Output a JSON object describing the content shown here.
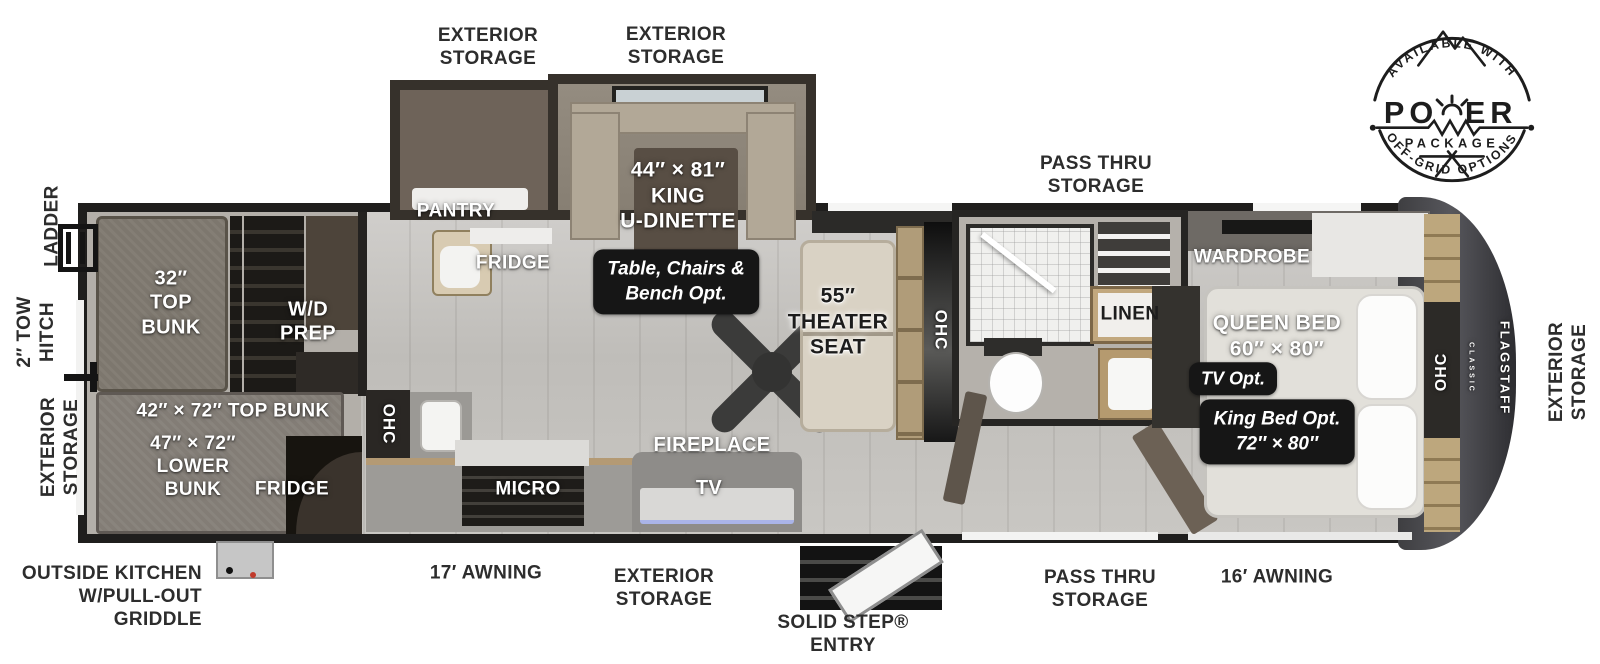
{
  "plan": {
    "exterior": {
      "ext_storage_top_left": "EXTERIOR\nSTORAGE",
      "ext_storage_top_right": "EXTERIOR\nSTORAGE",
      "pass_thru_top": "PASS THRU\nSTORAGE",
      "ladder": "LADDER",
      "tow_hitch": "2″ TOW\nHITCH",
      "ext_storage_rear": "EXTERIOR\nSTORAGE",
      "ext_storage_front": "EXTERIOR\nSTORAGE",
      "outside_kitchen": "OUTSIDE KITCHEN\nW/PULL-OUT\nGRIDDLE",
      "awning_17": "17′ AWNING",
      "ext_storage_bottom": "EXTERIOR\nSTORAGE",
      "solid_step": "SOLID STEP®\nENTRY",
      "pass_thru_bottom": "PASS THRU\nSTORAGE",
      "awning_16": "16′ AWNING"
    },
    "interior": {
      "pantry": "PANTRY",
      "fridge": "FRIDGE",
      "dinette": "44″ × 81″\nKING\nU-DINETTE",
      "dinette_option": "Table, Chairs &\nBench Opt.",
      "theater_seat": "55″\nTHEATER\nSEAT",
      "ohc_theater": "OHC",
      "ohc_kitchen": "OHC",
      "micro": "MICRO",
      "fireplace": "FIREPLACE",
      "tv": "TV",
      "bunk_top_32": "32″\nTOP\nBUNK",
      "wd_prep": "W/D\nPREP",
      "bunk_top_42": "42″ × 72″ TOP BUNK",
      "bunk_lower_47": "47″ × 72″\nLOWER\nBUNK",
      "bunk_fridge": "FRIDGE",
      "wardrobe": "WARDROBE",
      "linen": "LINEN",
      "queen_bed": "QUEEN BED\n60″ × 80″",
      "tv_option": "TV Opt.",
      "king_bed_option": "King Bed Opt.\n72″ × 80″",
      "ohc_bedroom": "OHC"
    },
    "brand": {
      "name": "FLAGSTAFF",
      "series": "CLASSIC"
    },
    "badge": {
      "top_arc": "AVAILABLE WITH",
      "power_left": "PO",
      "power_right": "ER",
      "package": "PACKAGE",
      "bottom_arc": "OFF-GRID OPTIONS"
    },
    "colors": {
      "label": "#2d2d2d",
      "wall": "#1f1e1d",
      "floor": "#c6c4c0",
      "accent_wood": "#b49a74",
      "badge_bg": "#161616"
    }
  }
}
